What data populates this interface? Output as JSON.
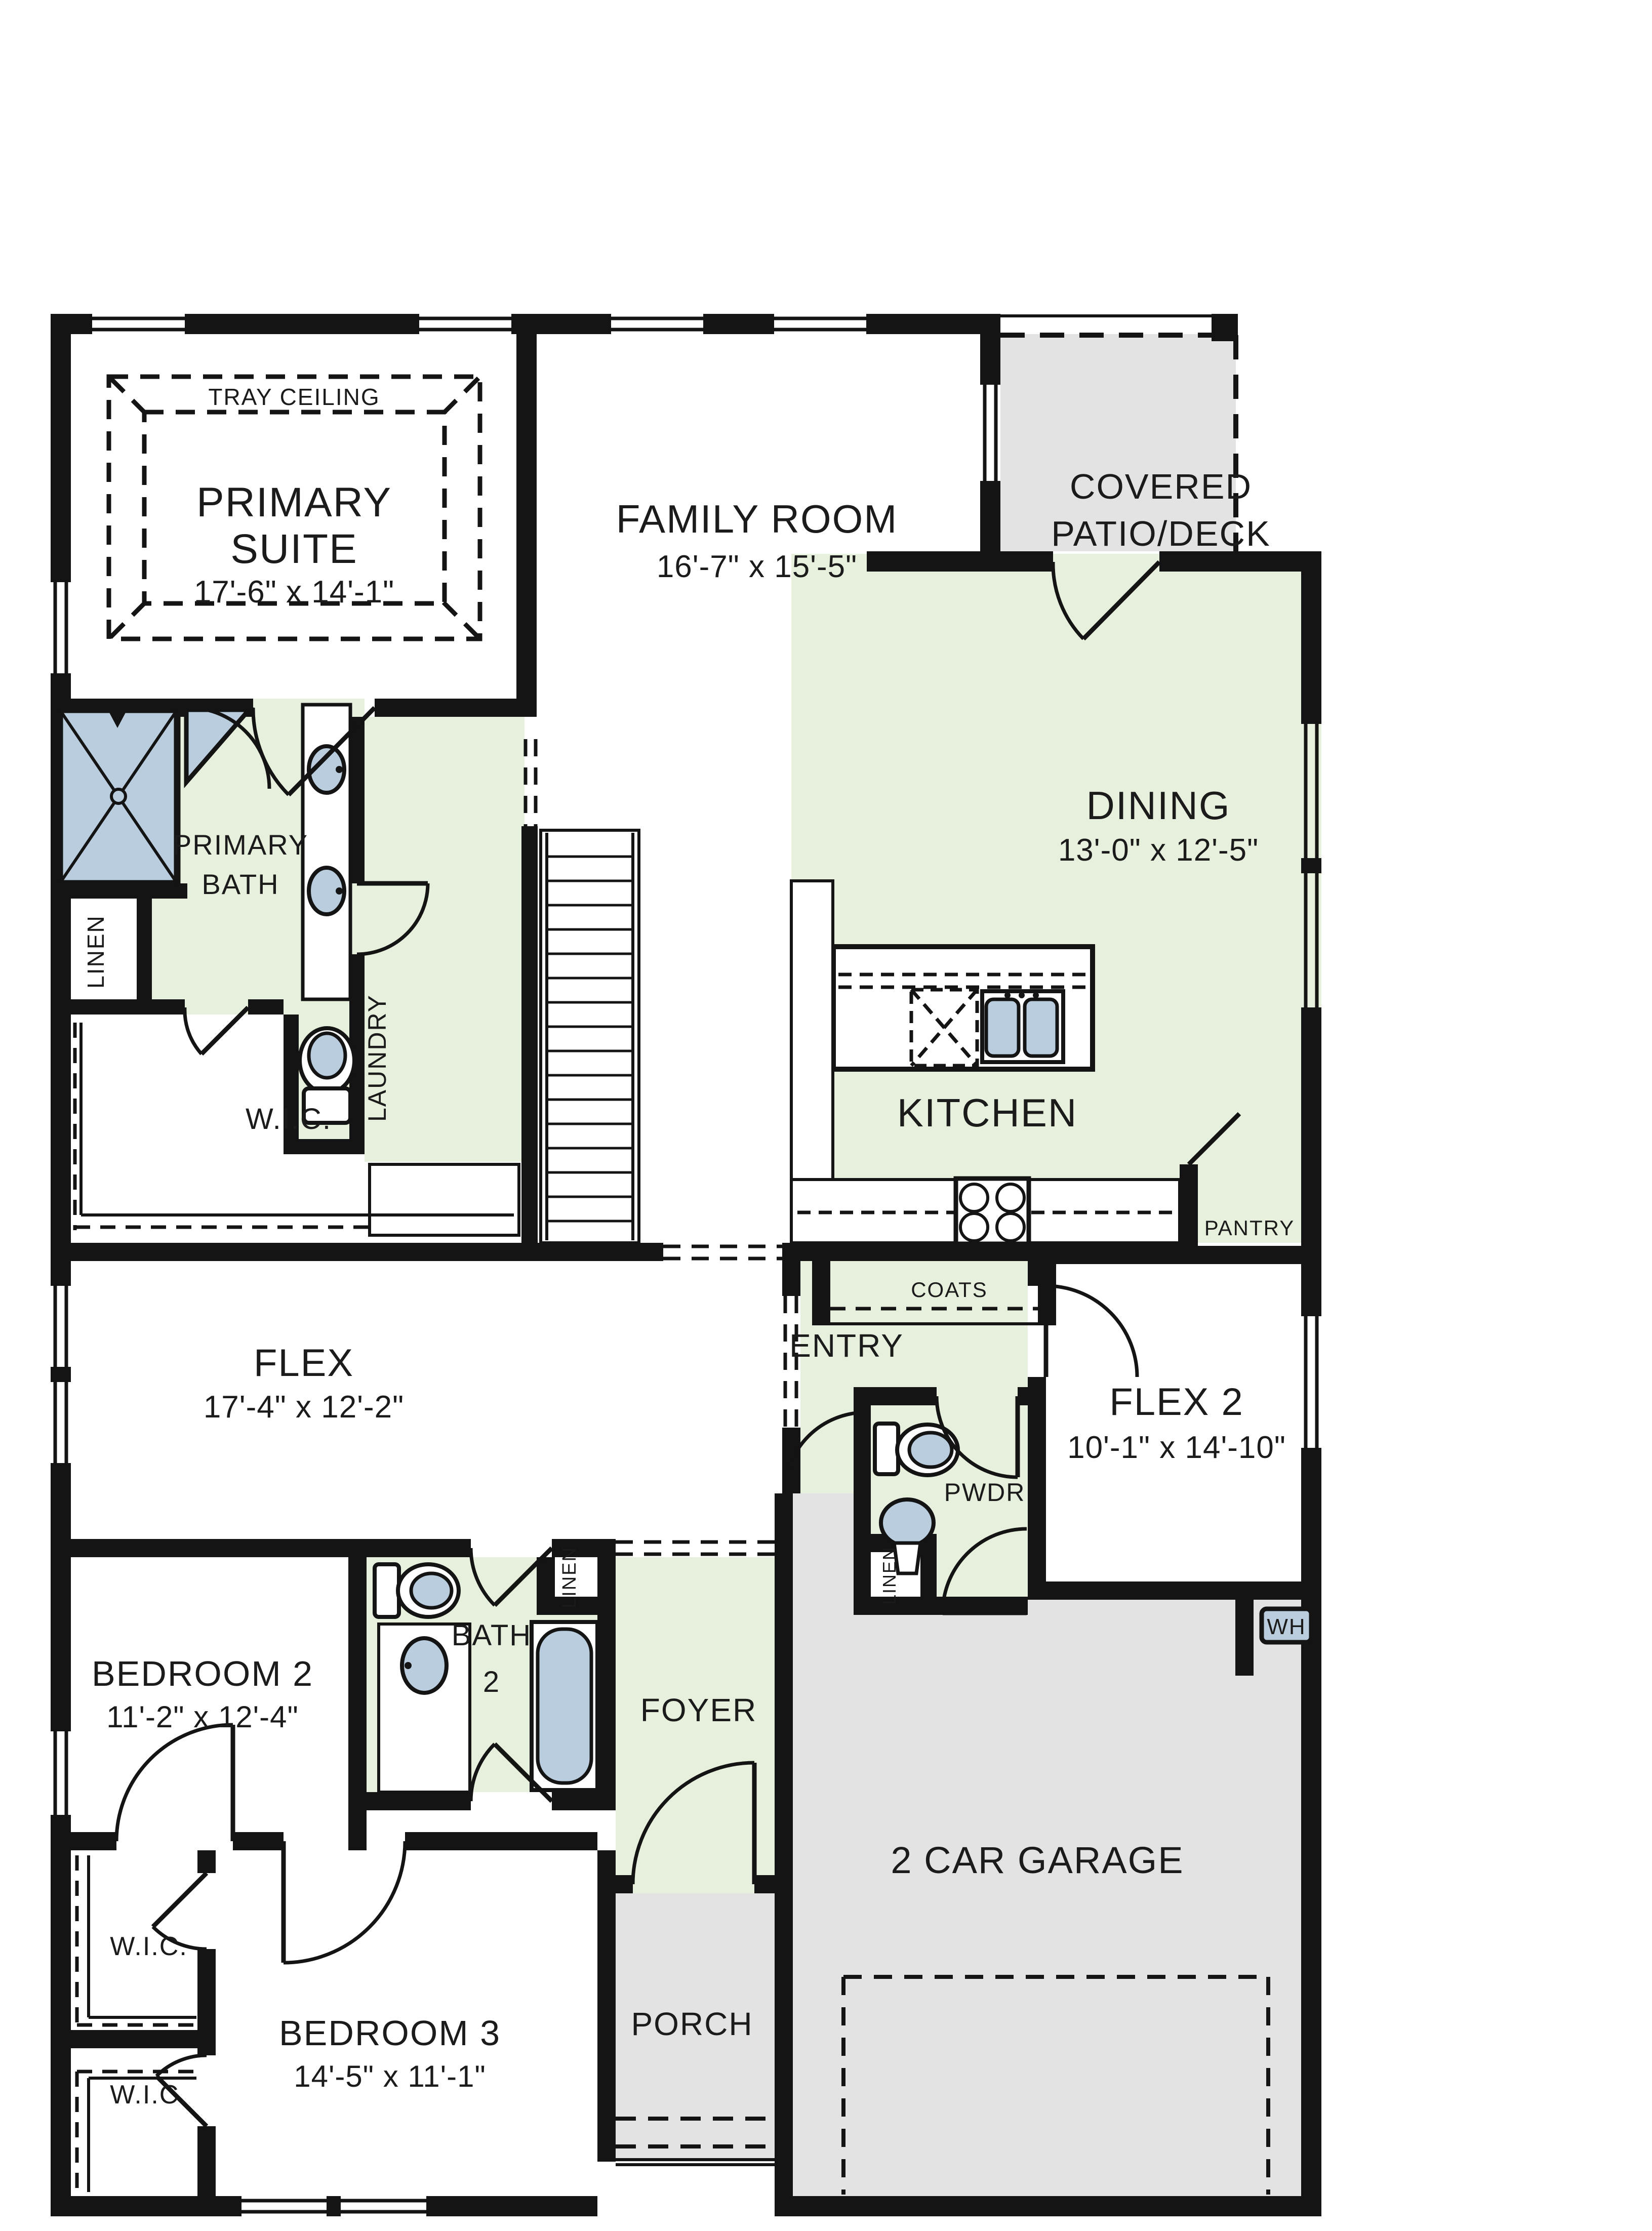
{
  "plan": {
    "rooms": {
      "tray_ceiling": "TRAY CEILING",
      "primary_suite": {
        "l1": "PRIMARY",
        "l2": "SUITE",
        "dims": "17'-6\" x 14'-1\""
      },
      "family_room": {
        "l1": "FAMILY ROOM",
        "dims": "16'-7\" x 15'-5\""
      },
      "covered_patio": {
        "l1": "COVERED",
        "l2": "PATIO/DECK"
      },
      "dining": {
        "l1": "DINING",
        "dims": "13'-0\" x 12'-5\""
      },
      "kitchen": {
        "l1": "KITCHEN"
      },
      "primary_bath": {
        "l1": "PRIMARY",
        "l2": "BATH"
      },
      "laundry": {
        "l1": "LAUNDRY"
      },
      "linen_primary": "LINEN",
      "wic_primary": "W.I.C.",
      "flex": {
        "l1": "FLEX",
        "dims": "17'-4\" x 12'-2\""
      },
      "coats": "COATS",
      "entry": "ENTRY",
      "pantry": "PANTRY",
      "flex2": {
        "l1": "FLEX 2",
        "dims": "10'-1\" x 14'-10\""
      },
      "pwdr": "PWDR",
      "linen_pwdr": "LINEN",
      "bedroom2": {
        "l1": "BEDROOM 2",
        "dims": "11'-2\" x 12'-4\""
      },
      "bath2": {
        "l1": "BATH",
        "l2": "2"
      },
      "linen_bath2": "LINEN",
      "foyer": "FOYER",
      "bedroom3": {
        "l1": "BEDROOM 3",
        "dims": "14'-5\" x 11'-1\""
      },
      "garage": "2 CAR GARAGE",
      "porch": "PORCH",
      "wic_bedroom3_upper": "W.I.C.",
      "wic_bedroom3_lower": "W.I.C.",
      "water_heater": "WH"
    },
    "colors": {
      "wall": "#141414",
      "room_green": "#e7f0dc",
      "area_gray": "#e3e3e3",
      "fixture_blue": "#b9cdde",
      "paper": "#ffffff"
    }
  }
}
